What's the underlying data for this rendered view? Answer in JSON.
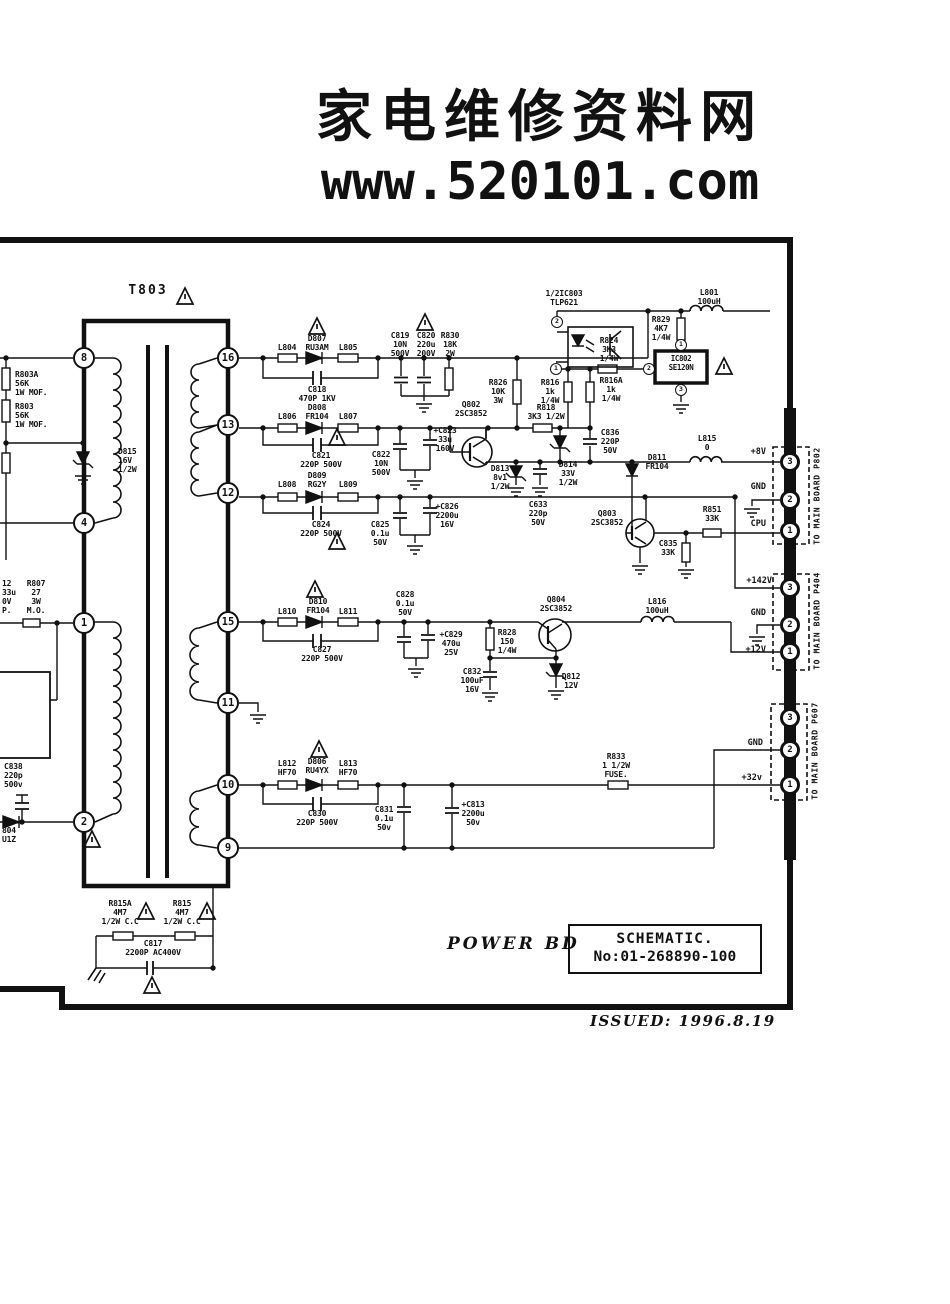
{
  "header": {
    "site_name": "家电维修资料网",
    "site_url": "www.520101.com"
  },
  "title_block": {
    "board": "POWER BD",
    "schematic": "SCHEMATIC.",
    "number": "No:01-268890-100",
    "issued": "ISSUED: 1996.8.19"
  },
  "transformer": {
    "name": "T803",
    "pins": {
      "p8": "8",
      "p4": "4",
      "p1": "1",
      "p2": "2",
      "p16": "16",
      "p13": "13",
      "p12": "12",
      "p15": "15",
      "p11": "11",
      "p10": "10",
      "p9": "9"
    }
  },
  "connectors": {
    "p802": {
      "name": "TO MAIN BOARD P802",
      "pin3": "3",
      "pin2": "2",
      "pin1": "1",
      "sig3": "+8V",
      "sig2": "GND",
      "sig1": "CPU"
    },
    "p404": {
      "name": "TO MAIN BOARD P404",
      "pin3": "3",
      "pin2": "2",
      "pin1": "1",
      "sig3": "+142V",
      "sig2": "GND",
      "sig1": "+12V"
    },
    "p607": {
      "name": "TO MAIN BOARD P607",
      "pin3": "3",
      "pin2": "2",
      "pin1": "1",
      "sig2": "GND",
      "sig1": "+32v"
    }
  },
  "ic": {
    "opto_name": "1/2IC803\nTLP621",
    "opto_pin_top": "2",
    "opto_pin_bot": "1",
    "reg_name": "IC802\nSE120N",
    "reg_pin1": "1",
    "reg_pin2": "2",
    "reg_pin3": "3"
  },
  "components": {
    "r803a": "R803A\n56K\n1W MOF.",
    "r803": "R803\n56K\n1W MOF.",
    "d815": "D815\n16V\n1/2W",
    "c812": "12\n33u\n0V\nP.",
    "r807": "R807\n27\n3W\nM.O.",
    "c838": "C838\n220p\n500v",
    "d804": "804\nU1Z",
    "l804": "L804",
    "d807": "D807\nRU3AM",
    "l805": "L805",
    "c818": "C818\n470P 1KV",
    "c819": "C819\n10N\n500V",
    "c820": "C820\n220u\n200V",
    "r830": "R830\n18K\n2W",
    "r826": "R826\n10K\n3W",
    "r824": "R824\n3K3\n1/4W",
    "r829": "R829\n4K7\n1/4W",
    "l801": "L801\n100uH",
    "r816": "R816\n1k\n1/4W",
    "r816a": "R816A\n1k\n1/4W",
    "r818": "R818\n3K3 1/2W",
    "q802": "Q802\n2SC3852",
    "l806": "L806",
    "d808": "D808\nFR104",
    "l807": "L807",
    "c821": "C821\n220P 500V",
    "c822": "C822\n10N\n500V",
    "c823": "+C823\n33u\n160V",
    "d813": "D813\n8v1\n1/2W",
    "c633": "C633\n220p\n50V",
    "d814": "D814\n33V\n1/2W",
    "c836": "C836\n220P\n50V",
    "d811": "D811\nFR104",
    "l808": "L808",
    "d809": "D809\nRG2Y",
    "l809": "L809",
    "c824": "C824\n220P 500V",
    "c825": "C825\n0.1u\n50V",
    "c826": "+C826\n2200u\n16V",
    "l815": "L815\n0",
    "r851": "R851\n33K",
    "q803": "Q803\n2SC3852",
    "c835": "C835\n33K",
    "l810": "L810",
    "d810": "D810\nFR104",
    "l811": "L811",
    "c827": "C827\n220P 500V",
    "c828": "C828\n0.1u\n50V",
    "c829": "+C829\n470u\n25V",
    "r828": "R828\n150\n1/4W",
    "q804": "Q804\n2SC3852",
    "c832": "C832\n100uF\n16V",
    "d812": "D812\n12V",
    "l816": "L816\n100uH",
    "l812": "L812\nHF70",
    "d806": "D806\nRU4YX",
    "l813": "L813\nHF70",
    "c830": "C830\n220P 500V",
    "c831": "C831\n0.1u\n50v",
    "c813": "+C813\n2200u\n50v",
    "r833": "R833\n1 1/2W\nFUSE.",
    "r815a": "R815A\n4M7\n1/2W C.C",
    "r815": "R815\n4M7\n1/2W C.C",
    "c817": "C817\n2200P AC400V"
  }
}
